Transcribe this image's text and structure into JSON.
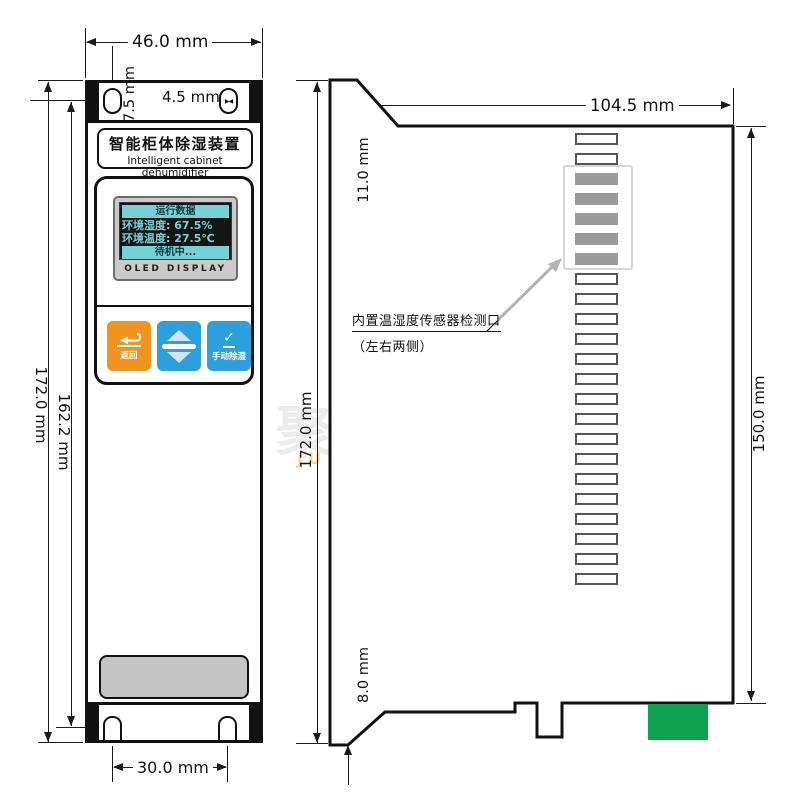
{
  "front": {
    "nameplate_cn": "智能柜体除湿装置",
    "nameplate_en": "Intelligent cabinet dehumidifier",
    "oled": {
      "header": "运行数据",
      "humidity": "环境湿度: 67.5%",
      "temperature": "环境温度: 27.5℃",
      "status": "待机中...",
      "caption": "OLED DISPLAY"
    },
    "buttons": {
      "back": "返回",
      "manual": "手动除湿"
    },
    "slot_marker": "▶◀"
  },
  "side": {
    "note_line1": "内置温湿度传感器检测口",
    "note_line2": "（左右两侧）",
    "vents": {
      "top_white": 2,
      "sensor_gray": 5,
      "bottom_white": 16
    }
  },
  "dimensions": {
    "front_width": "46.0 mm",
    "slot_offset": "7.5 mm",
    "slot_width": "4.5 mm",
    "front_height": "172.0 mm",
    "mount_span": "162.2 mm",
    "foot_pitch": "30.0 mm",
    "side_depth": "104.5 mm",
    "top_step": "11.0 mm",
    "side_height": "172.0 mm",
    "right_height": "150.0 mm",
    "bottom_step": "8.0 mm"
  },
  "watermark": {
    "cn": "聚信隆诚",
    "en": "JU XIN LONG CHENG"
  },
  "colors": {
    "button_back": "#f0931f",
    "button_blue": "#2aa0dc",
    "oled_band": "#74d1d6",
    "oled_screen": "#141414",
    "connector_green": "#0da24f",
    "grille_gray": "#c5c5c5"
  }
}
